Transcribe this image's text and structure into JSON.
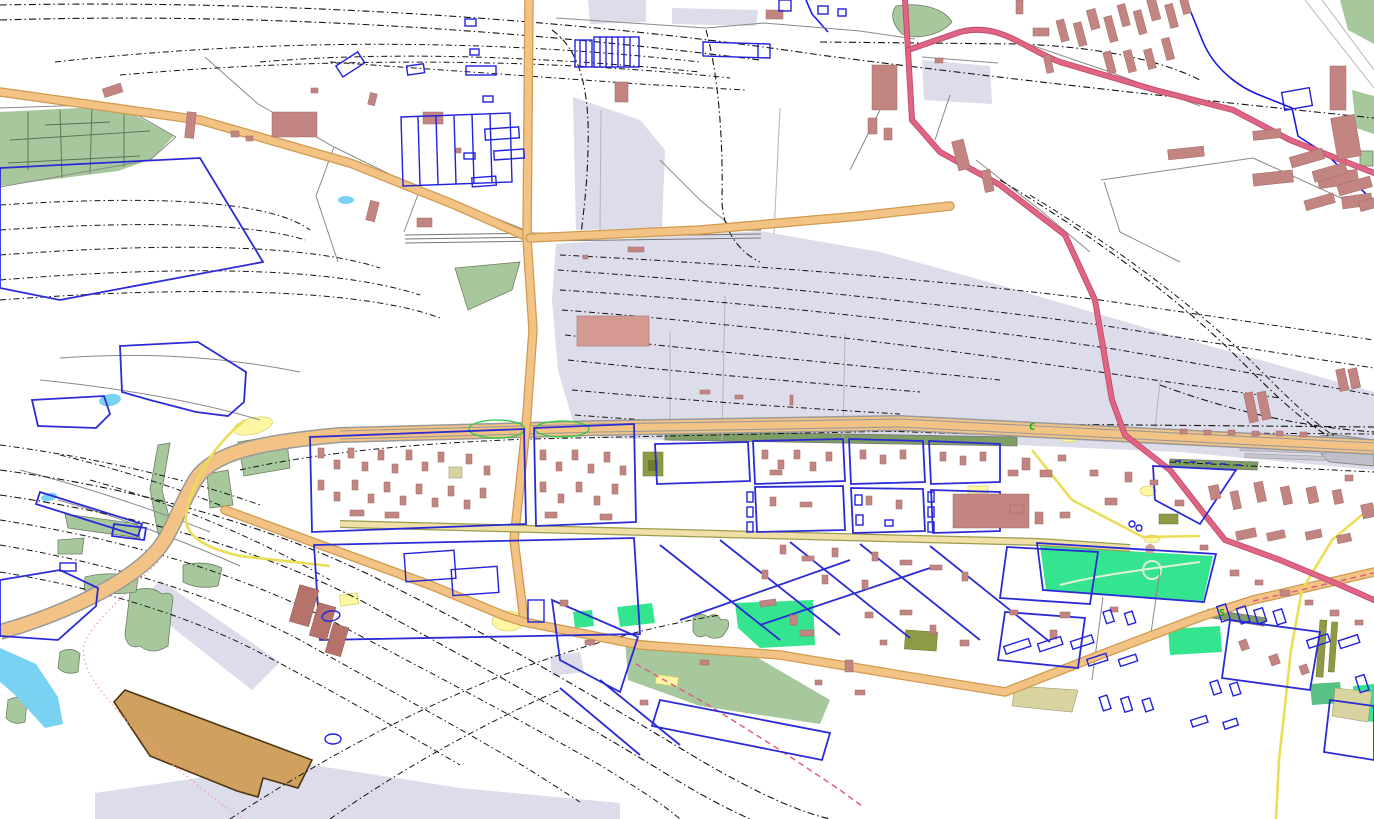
{
  "map": {
    "title": "rendered-street-map",
    "labels": [
      {
        "text": "C",
        "color": "#00b400"
      },
      {
        "text": "S",
        "color": "#00b400"
      }
    ],
    "palette": {
      "background": "#ffffff",
      "railway_land": "#dcdcea",
      "grass_sage": "#a7c89c",
      "platform_green": "#7e9e66",
      "park_spring_green": "#35e48e",
      "park_sea_green": "#57c083",
      "olive_area": "#8f9a45",
      "khaki_area": "#d9d3a0",
      "water": "#79d2f2",
      "river_line": "#1a1ae6",
      "brownfield": "#cfa05e",
      "station_gray": "#bfbfc9",
      "railway_line": "#141414",
      "minor_road": "#8a8a8a",
      "orange_road_fill": "#f2c385",
      "orange_road_casing": "#cf9a4e",
      "street_fill": "#f0dfa6",
      "street_casing": "#9c9c4f",
      "primary_pink_fill": "#e06484",
      "primary_pink_casing": "#bf4e6a",
      "yellow_road": "#ebdd55",
      "building_rose": "#c28581",
      "building_dark_rose": "#b5736c",
      "building_outline_blue": "#2222dd",
      "highlight_green_ellipse": "#2fcc42",
      "boundary_dotted": "#ff9c9c",
      "label_green": "#00b400"
    },
    "features": [
      "railway-yard",
      "railway-track-fans",
      "trunk-highway",
      "orange-roads",
      "pink-primary-roads",
      "yellow-roads",
      "residential-street",
      "industrial-blocks",
      "rose-buildings",
      "blue-outlined-buildings",
      "allotment-field",
      "parks",
      "river",
      "ponds",
      "brownfield-polygon",
      "station-area",
      "administrative-boundary"
    ]
  }
}
